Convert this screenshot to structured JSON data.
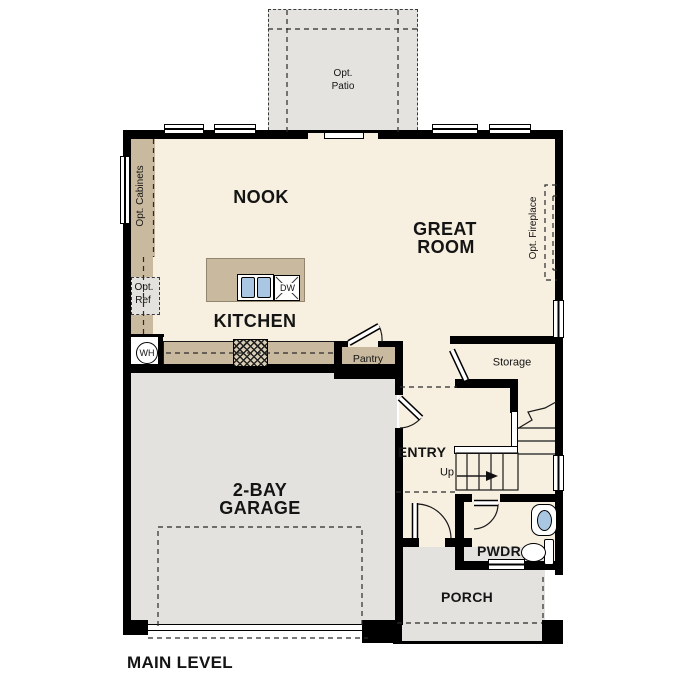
{
  "plan": {
    "title": "MAIN LEVEL",
    "rooms": {
      "nook": "NOOK",
      "great1": "GREAT",
      "great2": "ROOM",
      "kitchen": "KITCHEN",
      "garage1": "2-BAY",
      "garage2": "GARAGE",
      "entry": "ENTRY",
      "pwdr": "PWDR",
      "porch": "PORCH",
      "storage": "Storage",
      "pantry": "Pantry"
    },
    "options": {
      "patio1": "Opt.",
      "patio2": "Patio",
      "cabinets": "Opt. Cabinets",
      "ref1": "Opt.",
      "ref2": "Ref",
      "fireplace": "Opt. Fireplace"
    },
    "fixtures": {
      "water_heater": "WH",
      "dishwasher": "DW",
      "stairs_up": "Up"
    },
    "colors": {
      "floor": "#f7efdf",
      "cabinetry": "#c9b99e",
      "exterior_concrete": "#e3e2de",
      "wall": "#000000",
      "sink_blue": "#a9c6e2"
    }
  }
}
